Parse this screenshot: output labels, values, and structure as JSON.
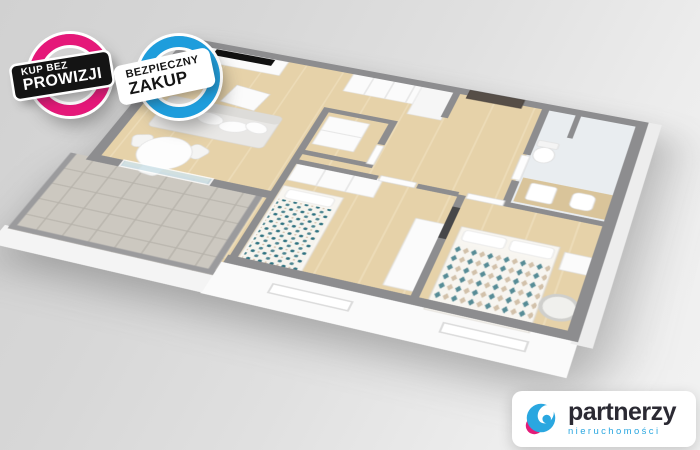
{
  "badges": [
    {
      "line1": "KUP BEZ",
      "line2": "PROWIZJI",
      "ring_color": "#e51879",
      "banner_bg": "#141414",
      "banner_text_color": "#ffffff"
    },
    {
      "line1": "BEZPIECZNY",
      "line2": "ZAKUP",
      "ring_color": "#1e9ddc",
      "banner_bg": "#ffffff",
      "banner_text_color": "#141414"
    }
  ],
  "logo": {
    "name": "partnerzy",
    "subtitle": "nieruchomości",
    "name_color": "#2b2a33",
    "subtitle_color": "#2aa7e0",
    "icon_blue": "#2aa7e0",
    "icon_pink": "#e31c79"
  },
  "colors": {
    "wall": "#8d8d8f",
    "railing": "#9b9b9d",
    "wood_floor": "#e6d2a9",
    "wood_plank": "#f2e4c4",
    "balcony_tile": "#ccc8c0",
    "tile_line": "#b7b3ab",
    "bath_floor": "#e9edf0",
    "facade": "#fafafa",
    "furniture_white": "#fbfbfb",
    "sofa_gray": "#e9e8e6",
    "tv_black": "#111111",
    "door_dark": "#564e47",
    "bedding_teal": "#2f7280",
    "bedding_sand": "#cbb79e",
    "counter_wood": "#d9c49a",
    "glass": "#cfe3ea"
  }
}
